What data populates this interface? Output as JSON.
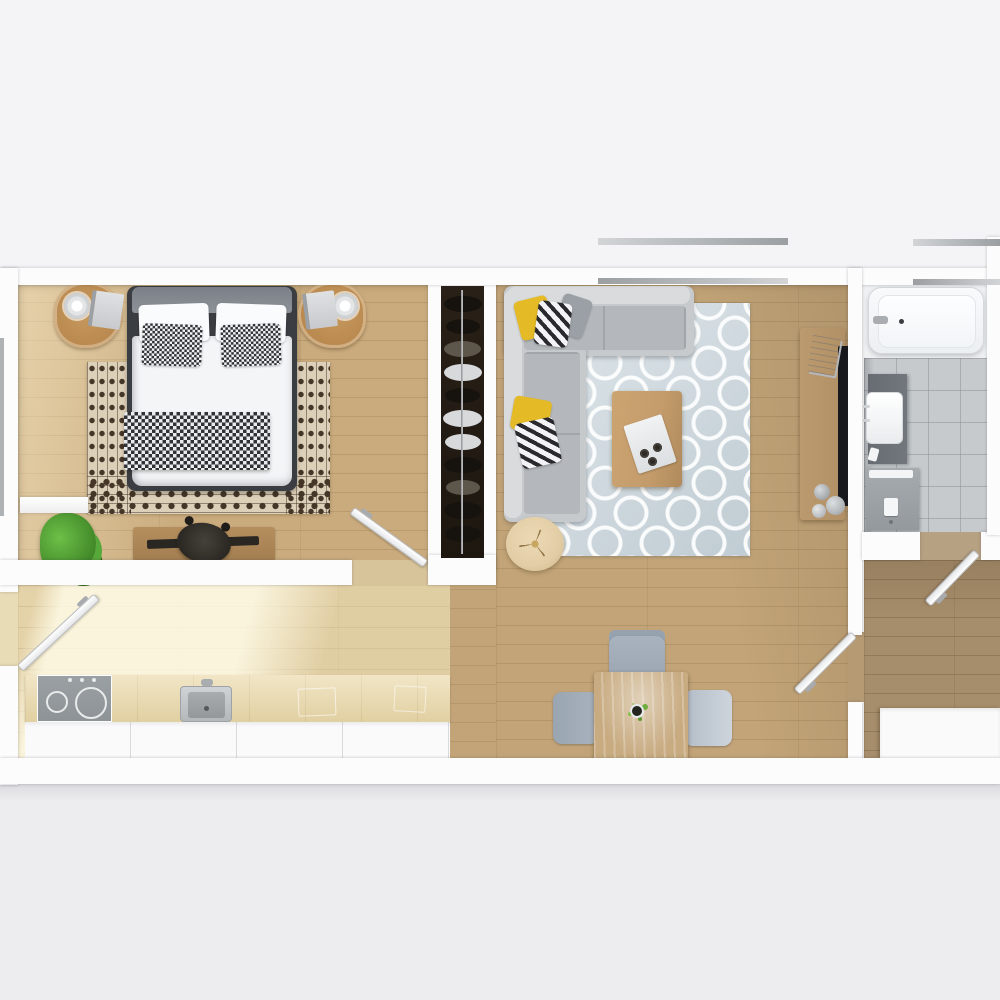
{
  "scene": {
    "type": "floor-plan",
    "view": "top-down 3D render, one-bedroom apartment",
    "rooms": {
      "bedroom": {
        "label": "Bedroom",
        "furniture": [
          "double-bed",
          "nightstand-left",
          "nightstand-right",
          "tribal-rug",
          "desk",
          "desk-chair",
          "potted-plant",
          "window-shelf"
        ]
      },
      "closet": {
        "label": "Wardrobe",
        "furniture": [
          "clothes-rail",
          "hanging-clothes"
        ]
      },
      "living": {
        "label": "Living room",
        "furniture": [
          "corner-sofa",
          "trellis-rug",
          "coffee-table",
          "round-pouf",
          "media-console",
          "tv-panel",
          "magazines",
          "vases"
        ]
      },
      "kitchen": {
        "label": "Kitchen",
        "furniture": [
          "counter",
          "cooktop",
          "sink",
          "cabinets"
        ]
      },
      "dining": {
        "label": "Dining area",
        "furniture": [
          "dining-table",
          "chair-top",
          "chair-left",
          "chair-right",
          "table-plant"
        ]
      },
      "bathroom": {
        "label": "Bathroom",
        "furniture": [
          "bathtub",
          "vanity",
          "sink",
          "washing-machine"
        ]
      },
      "entry": {
        "label": "Entry hall",
        "furniture": [
          "cabinet"
        ]
      }
    },
    "door_count": 4,
    "window_count": 3
  },
  "colors": {
    "wall": "#fcfcfd",
    "bg-top": "#f4f4f6",
    "bg-main": "#f1f1f3",
    "bg-bottom": "#ededf0",
    "floor-bedroom": "#c9ab7d",
    "floor-living": "#c2a478",
    "floor-kitchen": "#e4d2a8",
    "floor-entry": "#a68d6b",
    "bath-tile": "#c6cacd",
    "tub-white": "#f9fafb",
    "rug-bed-base": "#ddd0b9",
    "rug-bed-pattern": "#453628",
    "rug-living-base": "#cdd8de",
    "sofa-body": "#c7cacc",
    "sofa-back": "#d9dbdd",
    "sofa-seat": "#b4b8bc",
    "pillow-yellow": "#e4ba27",
    "pillow-gray": "#9aa0a6",
    "stripe-dark": "#2a2a2e",
    "bed-frame": "#3a3d41",
    "duvet": "#f4f5f7",
    "headboard-throw": "#7b8087",
    "check-dark": "#303236",
    "wood-nightstand": "#b8884f",
    "wood-desk": "#b68e5e",
    "wood-coffee": "#c49c6c",
    "wood-console": "#b29066",
    "wood-dining": "#c8ab81",
    "counter-top": "#ead8a8",
    "cabinet-white": "#fafafb",
    "tv-black": "#17181b",
    "closet-dark": "#292017",
    "cloth-dark": "#16120d",
    "cloth-mid": "#5d574b",
    "cloth-light": "#d7d9db",
    "stove-gray": "#9aa0a3",
    "steel": "#a9adb0",
    "chair-gray": "#a9b3bf",
    "plant-green": "#57a13a",
    "pouf-beige": "#e2cda6",
    "vanity-dark": "#71777d",
    "washer-gray": "#a6abaf",
    "window-line": "#aeb2b5"
  }
}
